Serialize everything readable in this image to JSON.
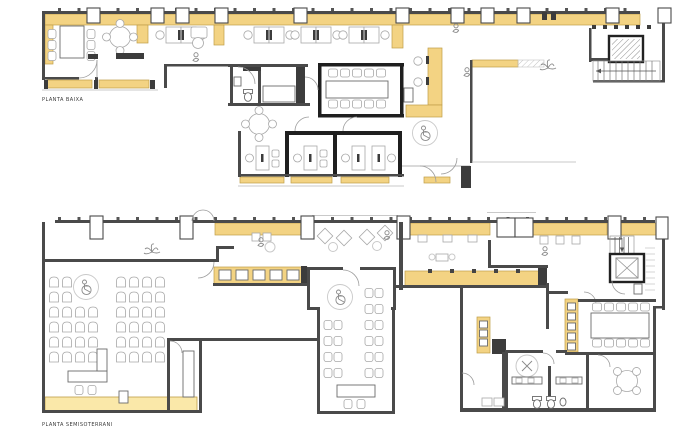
{
  "document": {
    "background": "#ffffff",
    "type_note": "architectural floor plan drawing, two levels"
  },
  "colors": {
    "wall": "#4a4a4a",
    "wall_black": "#1f1f1f",
    "furniture_line": "#a8a8a8",
    "furniture_dark": "#6b6b6b",
    "yellow": "#f3d383",
    "yellow_light": "#fae8a9",
    "yellow_border": "#bf9e48",
    "label_text": "#3a3a3a",
    "arc": "#9c9c9c",
    "light": "#c9c9c9"
  },
  "plans": {
    "top": {
      "label": "PLANTA BAIXA"
    },
    "bottom": {
      "label": "PLANTA SEMISOTERRANI"
    }
  }
}
